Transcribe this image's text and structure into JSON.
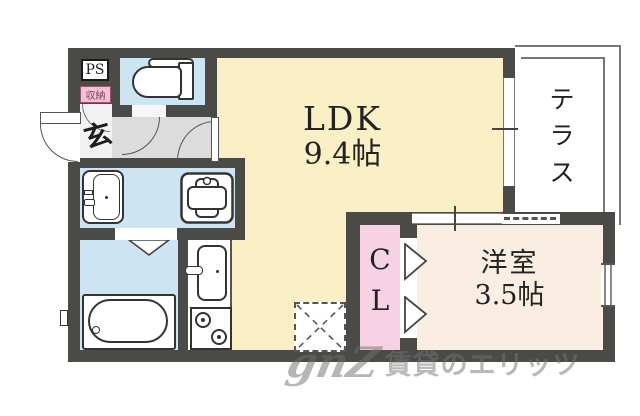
{
  "rooms": {
    "ldk": {
      "name": "LDK",
      "size": "9.4帖"
    },
    "western": {
      "name": "洋室",
      "size": "3.5帖"
    },
    "terrace": {
      "name": "テラス"
    },
    "closet": {
      "name": "CL"
    },
    "pipe_space": {
      "name": "PS"
    },
    "storage": {
      "name": "収納"
    },
    "entrance": {
      "name": "玄"
    }
  },
  "watermark": {
    "logo": "gnZ",
    "text": "賃貸のエリッツ"
  },
  "fixtures": [
    "toilet",
    "washbasin",
    "washing-machine-pan",
    "bathtub",
    "kitchen-sink",
    "stove",
    "refrigerator-space"
  ],
  "colors": {
    "wall": "#4a4a46",
    "ldk_fill": "#fbf0c5",
    "wet_room_fill": "#cde4f3",
    "western_room_fill": "#faeee3",
    "closet_fill": "#f6d2e4",
    "hallway_fill": "#dcdcdc",
    "entry_fill": "#f2f2f2",
    "storage_label_bg": "#eec3d6",
    "storage_label_text": "#8c3a55",
    "line": "#555555"
  }
}
